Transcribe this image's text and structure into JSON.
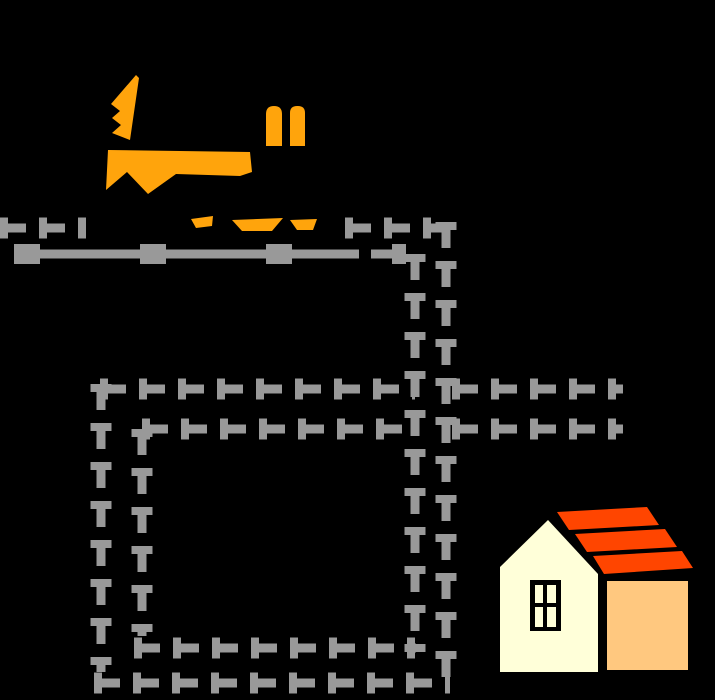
{
  "canvas": {
    "width": 715,
    "height": 700,
    "background": "#000000"
  },
  "palette": {
    "maze_gray": "#999999",
    "fox_orange": "#FFA40C",
    "roof_red": "#FF4500",
    "house_cream": "#FFFFD9",
    "house_side_orange": "#FFC87F",
    "outline_black": "#000000"
  },
  "fox": {
    "fill": "#FFA40C",
    "polygons": {
      "tail": [
        [
          136,
          75
        ],
        [
          139,
          78
        ],
        [
          130,
          140
        ],
        [
          112,
          133
        ],
        [
          121,
          125
        ],
        [
          112,
          118
        ],
        [
          120,
          111
        ],
        [
          111,
          104
        ]
      ],
      "body": [
        [
          108,
          150
        ],
        [
          250,
          152
        ],
        [
          252,
          172
        ],
        [
          240,
          176
        ],
        [
          176,
          174
        ],
        [
          148,
          194
        ],
        [
          127,
          172
        ],
        [
          106,
          190
        ]
      ],
      "front-foot": [
        [
          191,
          219
        ],
        [
          213,
          216
        ],
        [
          212,
          226
        ],
        [
          196,
          228
        ]
      ],
      "middle-foot": [
        [
          232,
          220
        ],
        [
          283,
          218
        ],
        [
          272,
          231
        ],
        [
          242,
          231
        ]
      ],
      "back-foot": [
        [
          290,
          220
        ],
        [
          317,
          219
        ],
        [
          313,
          230
        ],
        [
          297,
          230
        ]
      ]
    },
    "ears": [
      {
        "x": 266,
        "y": 106,
        "w": 16,
        "h": 40,
        "r": 8
      },
      {
        "x": 290,
        "y": 106,
        "w": 15,
        "h": 40,
        "r": 7
      }
    ]
  },
  "maze": {
    "color": "#999999",
    "main_width": 9,
    "tick_width": 21,
    "main_dash": "26 13",
    "tick_dash": "8 31",
    "segments": [
      {
        "name": "top-outer-row-left",
        "x1": 0,
        "y1": 228,
        "x2": 86,
        "y2": 228
      },
      {
        "name": "top-outer-row-right",
        "x1": 345,
        "y1": 228,
        "x2": 448,
        "y2": 228
      },
      {
        "name": "top-inner-row",
        "x1": 14,
        "y1": 254,
        "x2": 406,
        "y2": 254,
        "dash": "345 12",
        "tick_dash": "26 100",
        "tick_width": 20
      },
      {
        "name": "right-inner-col",
        "x1": 415,
        "y1": 254,
        "x2": 415,
        "y2": 652
      },
      {
        "name": "right-outer-col",
        "x1": 446,
        "y1": 222,
        "x2": 446,
        "y2": 687
      },
      {
        "name": "middle-top-row",
        "x1": 100,
        "y1": 389,
        "x2": 415,
        "y2": 389
      },
      {
        "name": "branch-top-row",
        "x1": 452,
        "y1": 389,
        "x2": 623,
        "y2": 389
      },
      {
        "name": "middle-bottom-row",
        "x1": 142,
        "y1": 429,
        "x2": 415,
        "y2": 429
      },
      {
        "name": "branch-bottom-row",
        "x1": 452,
        "y1": 429,
        "x2": 623,
        "y2": 429
      },
      {
        "name": "left-outer-col",
        "x1": 101,
        "y1": 384,
        "x2": 101,
        "y2": 672
      },
      {
        "name": "left-inner-col",
        "x1": 142,
        "y1": 429,
        "x2": 142,
        "y2": 636
      },
      {
        "name": "bottom-inner-row",
        "x1": 134,
        "y1": 648,
        "x2": 416,
        "y2": 648
      },
      {
        "name": "bottom-outer-row",
        "x1": 94,
        "y1": 683,
        "x2": 450,
        "y2": 683
      }
    ]
  },
  "house": {
    "facade": {
      "fill": "#FFFFD9",
      "points": [
        [
          500,
          567
        ],
        [
          548,
          520
        ],
        [
          598,
          574
        ],
        [
          598,
          672
        ],
        [
          500,
          672
        ]
      ]
    },
    "side_wall": {
      "fill": "#FFC87F",
      "x": 607,
      "y": 581,
      "w": 81,
      "h": 89
    },
    "window": {
      "frame": {
        "fill": "#000000",
        "x": 530,
        "y": 580,
        "w": 31,
        "h": 51
      },
      "pane_fill": "#FFFFD9",
      "panes": [
        [
          535,
          585,
          8,
          18
        ],
        [
          547,
          585,
          9,
          18
        ],
        [
          535,
          607,
          8,
          20
        ],
        [
          547,
          607,
          9,
          20
        ]
      ]
    },
    "roof_stripes": {
      "fill": "#FF4500",
      "stripes": [
        [
          [
            557,
            512
          ],
          [
            647,
            507
          ],
          [
            659,
            525
          ],
          [
            569,
            530
          ]
        ],
        [
          [
            575,
            534
          ],
          [
            665,
            529
          ],
          [
            677,
            547
          ],
          [
            587,
            552
          ]
        ],
        [
          [
            593,
            556
          ],
          [
            682,
            551
          ],
          [
            693,
            568
          ],
          [
            604,
            574
          ]
        ]
      ]
    }
  }
}
